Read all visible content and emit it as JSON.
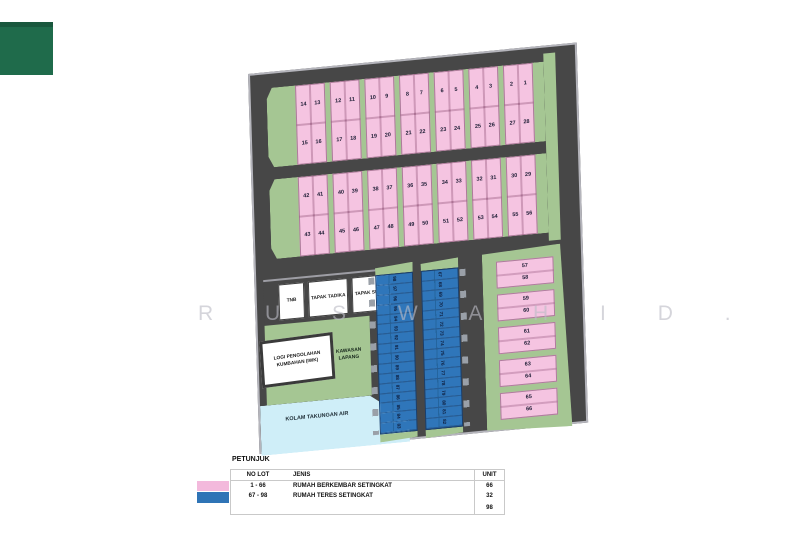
{
  "corner_square": {
    "color": "#1f6b4b"
  },
  "watermark": {
    "text": "R U S W A H I D ."
  },
  "plan": {
    "colors": {
      "road": "#474747",
      "pink": "#f5c4e1",
      "green": "#a5c693",
      "blue": "#2f76ba",
      "pond": "#cfeef8"
    },
    "blocks": [
      {
        "id": "block-a",
        "quads": [
          {
            "top": [
              14,
              13
            ],
            "bottom": [
              15,
              16
            ]
          },
          {
            "top": [
              12,
              11
            ],
            "bottom": [
              17,
              18
            ]
          },
          {
            "top": [
              10,
              9
            ],
            "bottom": [
              19,
              20
            ]
          },
          {
            "top": [
              8,
              7
            ],
            "bottom": [
              21,
              22
            ]
          },
          {
            "top": [
              6,
              5
            ],
            "bottom": [
              23,
              24
            ]
          },
          {
            "top": [
              4,
              3
            ],
            "bottom": [
              25,
              26
            ]
          },
          {
            "top": [
              2,
              1
            ],
            "bottom": [
              27,
              28
            ]
          }
        ]
      },
      {
        "id": "block-b",
        "quads": [
          {
            "top": [
              42,
              41
            ],
            "bottom": [
              43,
              44
            ]
          },
          {
            "top": [
              40,
              39
            ],
            "bottom": [
              45,
              46
            ]
          },
          {
            "top": [
              38,
              37
            ],
            "bottom": [
              47,
              48
            ]
          },
          {
            "top": [
              36,
              35
            ],
            "bottom": [
              49,
              50
            ]
          },
          {
            "top": [
              34,
              33
            ],
            "bottom": [
              51,
              52
            ]
          },
          {
            "top": [
              32,
              31
            ],
            "bottom": [
              53,
              54
            ]
          },
          {
            "top": [
              30,
              29
            ],
            "bottom": [
              55,
              56
            ]
          }
        ]
      }
    ],
    "terrace_columns": {
      "left": [
        98,
        97,
        96,
        95,
        94,
        93,
        92,
        91,
        90,
        89,
        88,
        87,
        86,
        85,
        84,
        83
      ],
      "right": [
        67,
        68,
        69,
        70,
        71,
        72,
        73,
        74,
        75,
        76,
        77,
        78,
        79,
        80,
        81,
        82
      ]
    },
    "east_pairs": [
      [
        57,
        58
      ],
      [
        59,
        60
      ],
      [
        61,
        62
      ],
      [
        63,
        64
      ],
      [
        65,
        66
      ]
    ],
    "facilities": {
      "tnb": "TNB",
      "tadika": "TAPAK TADIKA",
      "surau": "TAPAK SURAU",
      "iwk": "LOGI PENGOLAHAN KUMBAHAN (IWK)",
      "lapang": "KAWASAN LAPANG",
      "kolam": "KOLAM TAKUNGAN AIR"
    }
  },
  "legend": {
    "title": "PETUNJUK",
    "columns": [
      "NO LOT",
      "JENIS",
      "UNIT"
    ],
    "rows": [
      {
        "swatch": "#f3b9dc",
        "no_lot": "1 - 66",
        "jenis": "RUMAH BERKEMBAR SETINGKAT",
        "unit": "66"
      },
      {
        "swatch": "#2f74b6",
        "no_lot": "67 - 98",
        "jenis": "RUMAH TERES SETINGKAT",
        "unit": "32"
      }
    ],
    "total_unit": "98"
  }
}
